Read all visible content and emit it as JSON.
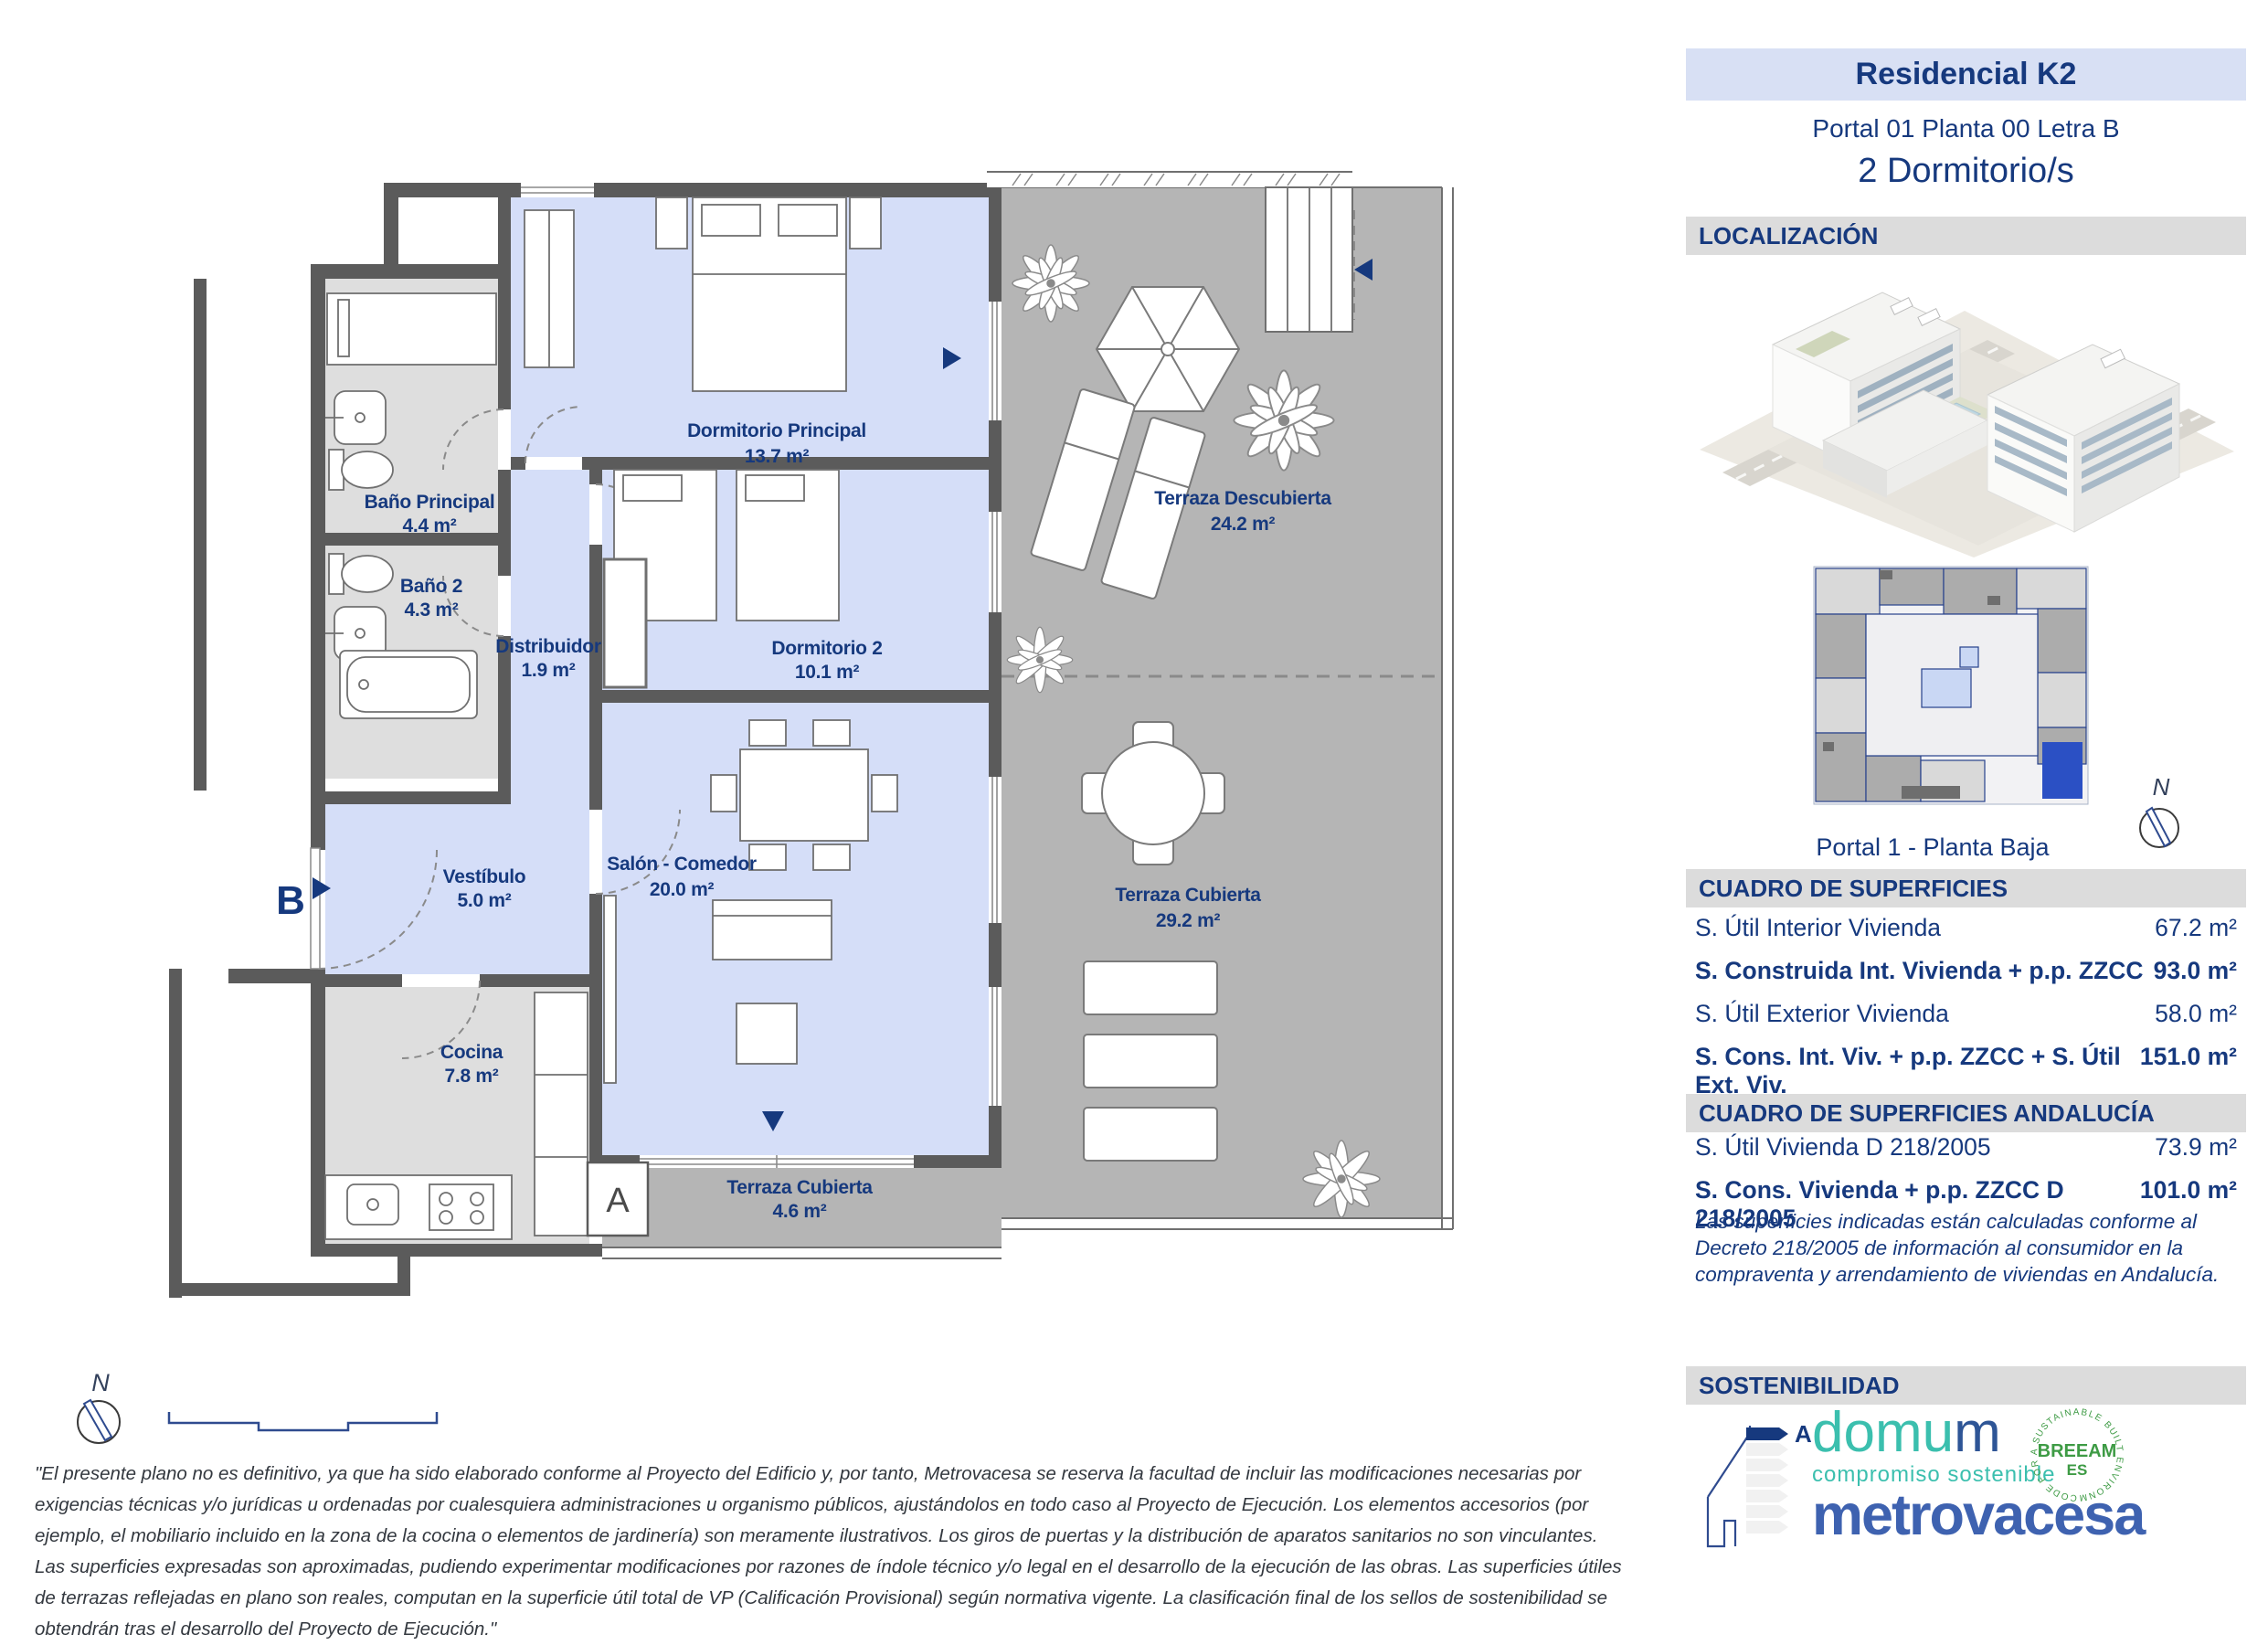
{
  "header": {
    "title": "Residencial K2",
    "subtitle": "Portal 01 Planta 00 Letra B",
    "bedrooms": "2 Dormitorio/s"
  },
  "sections": {
    "localizacion": "LOCALIZACIÓN",
    "superficies": "CUADRO DE SUPERFICIES",
    "superficies_andalucia": "CUADRO DE SUPERFICIES ANDALUCÍA",
    "sostenibilidad": "SOSTENIBILIDAD"
  },
  "keyplan": {
    "caption": "Portal 1 - Planta Baja",
    "north_label": "N"
  },
  "plan": {
    "rooms": [
      {
        "name": "Dormitorio Principal",
        "area": "13.7 m²"
      },
      {
        "name": "Baño Principal",
        "area": "4.4 m²"
      },
      {
        "name": "Baño 2",
        "area": "4.3 m²"
      },
      {
        "name": "Distribuidor",
        "area": "1.9 m²"
      },
      {
        "name": "Dormitorio 2",
        "area": "10.1 m²"
      },
      {
        "name": "Salón - Comedor",
        "area": "20.0 m²"
      },
      {
        "name": "Vestíbulo",
        "area": "5.0 m²"
      },
      {
        "name": "Cocina",
        "area": "7.8 m²"
      },
      {
        "name": "Terraza Descubierta",
        "area": "24.2 m²"
      },
      {
        "name": "Terraza Cubierta",
        "area": "29.2 m²"
      },
      {
        "name": "Terraza Cubierta",
        "area": "4.6 m²"
      }
    ],
    "markers": {
      "section_a": "A",
      "entrance_b": "B",
      "north": "N"
    }
  },
  "surfaces": {
    "rows": [
      {
        "label": "S. Útil Interior Vivienda",
        "value": "67.2 m²"
      },
      {
        "label": "S. Construida Int. Vivienda + p.p. ZZCC",
        "value": "93.0 m²"
      },
      {
        "label": "S. Útil Exterior Vivienda",
        "value": "58.0 m²"
      },
      {
        "label": "S. Cons. Int. Viv. + p.p. ZZCC + S. Útil Ext. Viv.",
        "value": "151.0 m²"
      }
    ]
  },
  "surfaces_andalucia": {
    "rows": [
      {
        "label": "S. Útil Vivienda D 218/2005",
        "value": "73.9 m²"
      },
      {
        "label": "S. Cons. Vivienda + p.p. ZZCC D 218/2005",
        "value": "101.0 m²"
      }
    ],
    "note": "Las superficies indicadas están calculadas conforme al Decreto 218/2005 de información al consumidor en la compraventa y arrendamiento de viviendas en Andalucía."
  },
  "logos": {
    "energy_rating": "A",
    "domum_teal": "domu",
    "domum_blue": "m",
    "domum_sub": "compromiso sostenible",
    "breeam_ring": "CODE FOR A SUSTAINABLE BUILT ENVIRONMENT",
    "breeam_main": "BREEAM",
    "breeam_sub": "ES",
    "metrovacesa": "metrovacesa"
  },
  "colors": {
    "navy": "#16397E",
    "room_fill": "#D5DEF8",
    "wet_room_fill": "#DEDEDE",
    "terrace_fill": "#B5B5B5",
    "wall": "#5B5B5B",
    "highlight_unit_blue": "#2B50C4",
    "metrovacesa_blue": "#3E62B0",
    "domum_teal": "#3BBFAE",
    "breeam_green": "#3E9B45"
  },
  "disclaimer": "\"El presente plano no es definitivo, ya que ha sido elaborado conforme al Proyecto del Edificio y, por tanto, Metrovacesa se reserva la facultad de incluir las modificaciones necesarias por exigencias técnicas y/o jurídicas u ordenadas por cualesquiera administraciones u organismo públicos, ajustándolos en todo caso al Proyecto de Ejecución. Los elementos accesorios (por ejemplo, el mobiliario incluido en la zona de la cocina o elementos de jardinería) son meramente ilustrativos. Los giros de puertas y la distribución de aparatos sanitarios no son vinculantes. Las superficies expresadas son aproximadas, pudiendo experimentar modificaciones por razones de índole técnico y/o legal en el desarrollo de la ejecución de las obras. Las superficies útiles de terrazas reflejadas en plano son reales, computan en la superficie útil total de VP (Calificación Provisional) según normativa vigente. La clasificación final de los sellos de sostenibilidad se obtendrán tras el desarrollo del Proyecto de Ejecución.\""
}
